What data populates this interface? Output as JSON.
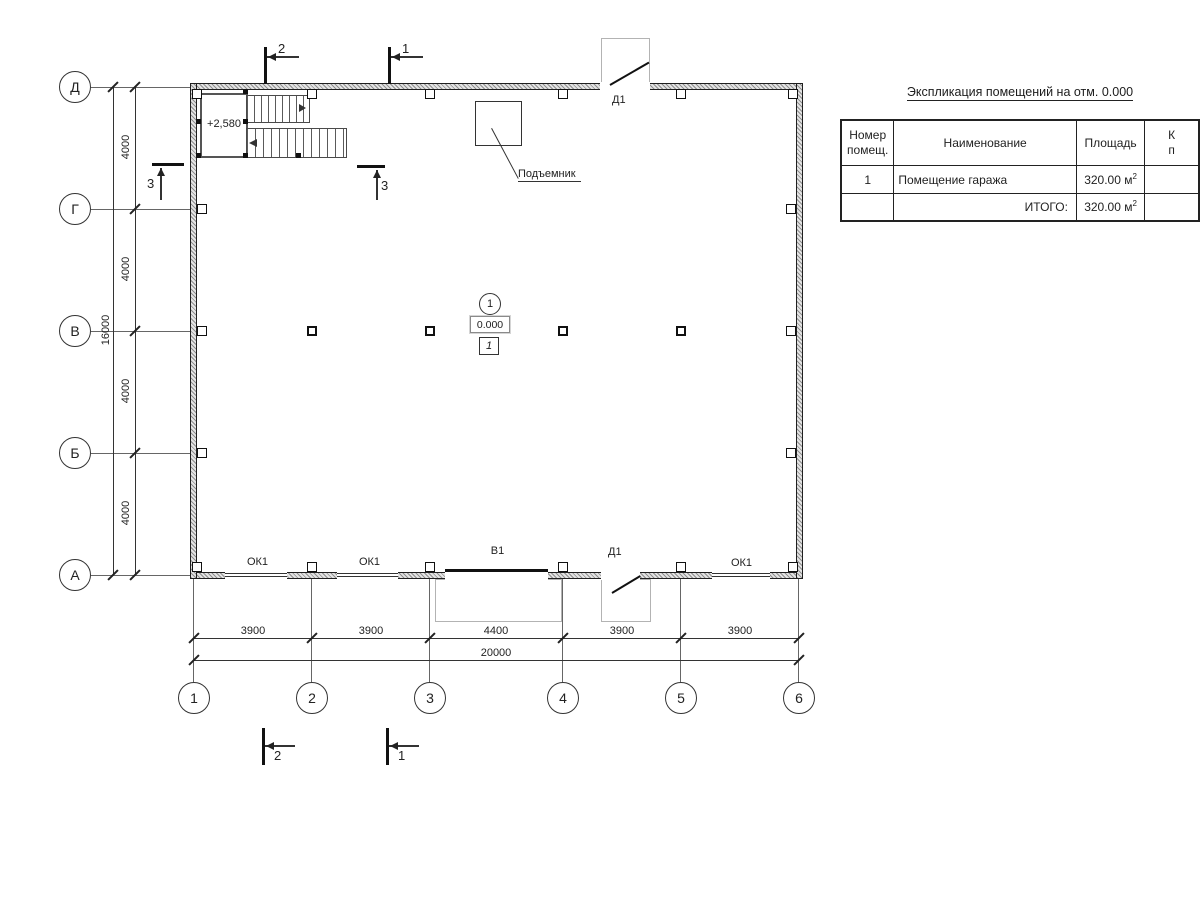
{
  "plan": {
    "hoist_label": "Подъемник",
    "stair_elevation": "+2,580",
    "room_marker": {
      "number": "1",
      "elevation": "0.000",
      "floor_type": "1"
    },
    "door_top_label": "Д1",
    "door_bottom_label": "Д1",
    "gate_label": "В1",
    "window_labels": [
      "ОК1",
      "ОК1",
      "ОК1"
    ]
  },
  "axes": {
    "cols": [
      "1",
      "2",
      "3",
      "4",
      "5",
      "6"
    ],
    "rows": [
      "Д",
      "Г",
      "В",
      "Б",
      "А"
    ]
  },
  "dims": {
    "bottom_segments": [
      "3900",
      "3900",
      "4400",
      "3900",
      "3900"
    ],
    "bottom_total": "20000",
    "left_segments": [
      "4000",
      "4000",
      "4000",
      "4000"
    ],
    "left_total": "16000"
  },
  "sections": {
    "top": [
      "2",
      "1"
    ],
    "bottom": [
      "2",
      "1"
    ],
    "stair": [
      "3",
      "3"
    ]
  },
  "table": {
    "title": "Экспликация помещений на отм. 0.000",
    "col_num": "Номер помещ.",
    "col_name": "Наименование",
    "col_area": "Площадь",
    "col_cut_l1": "К",
    "col_cut_l2": "п",
    "row1": {
      "num": "1",
      "name": "Помещение гаража",
      "area": "320.00 м",
      "area_sup": "2"
    },
    "total": {
      "label": "ИТОГО:",
      "area": "320.00 м",
      "area_sup": "2"
    }
  }
}
